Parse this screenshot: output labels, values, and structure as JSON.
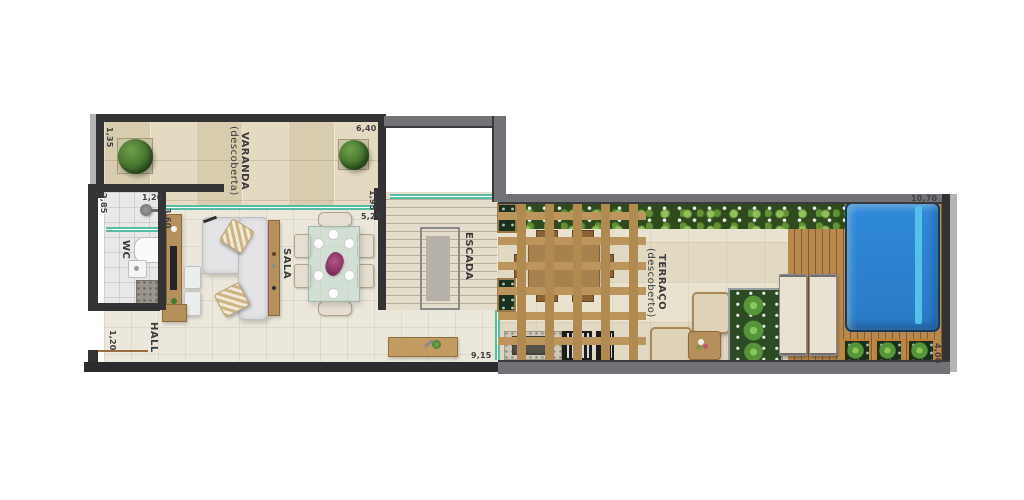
{
  "plan": {
    "rooms": {
      "varanda": {
        "label": "VARANDA",
        "sublabel": "(descoberta)"
      },
      "sala": {
        "label": "SALA"
      },
      "wc": {
        "label": "WC"
      },
      "hall": {
        "label": "HALL"
      },
      "escada": {
        "label": "ESCADA"
      },
      "terraco": {
        "label": "TERRAÇO",
        "sublabel": "(descoberto)"
      }
    },
    "dimensions": {
      "varanda_left": "1,35",
      "varanda_width": "6,40",
      "wc_width": "1,20",
      "wc_left": "2,85",
      "wc_right": "3,60",
      "sala_right_top": "1,95",
      "sala_right": "5,25",
      "hall_left": "1,20",
      "sala_bottom": "9,15",
      "terraco_width": "10,70",
      "terraco_right": "4,00"
    },
    "palette": {
      "wall_dark": "#333335",
      "wall_gray": "#717376",
      "floor_cream": "#ebe7db",
      "stone_beige": "#e0d6bc",
      "deck_wood": "#b8894f",
      "pergola_wood": "#b18a52",
      "furniture_wood": "#b5905c",
      "hedge_green": "#2f4a1d",
      "plant_green": "#57953a",
      "pool_blue": "#2e86d4",
      "pool_lane": "#55c0ea",
      "glass_teal": "#57bca4",
      "label_text": "#3b3b3d"
    }
  }
}
